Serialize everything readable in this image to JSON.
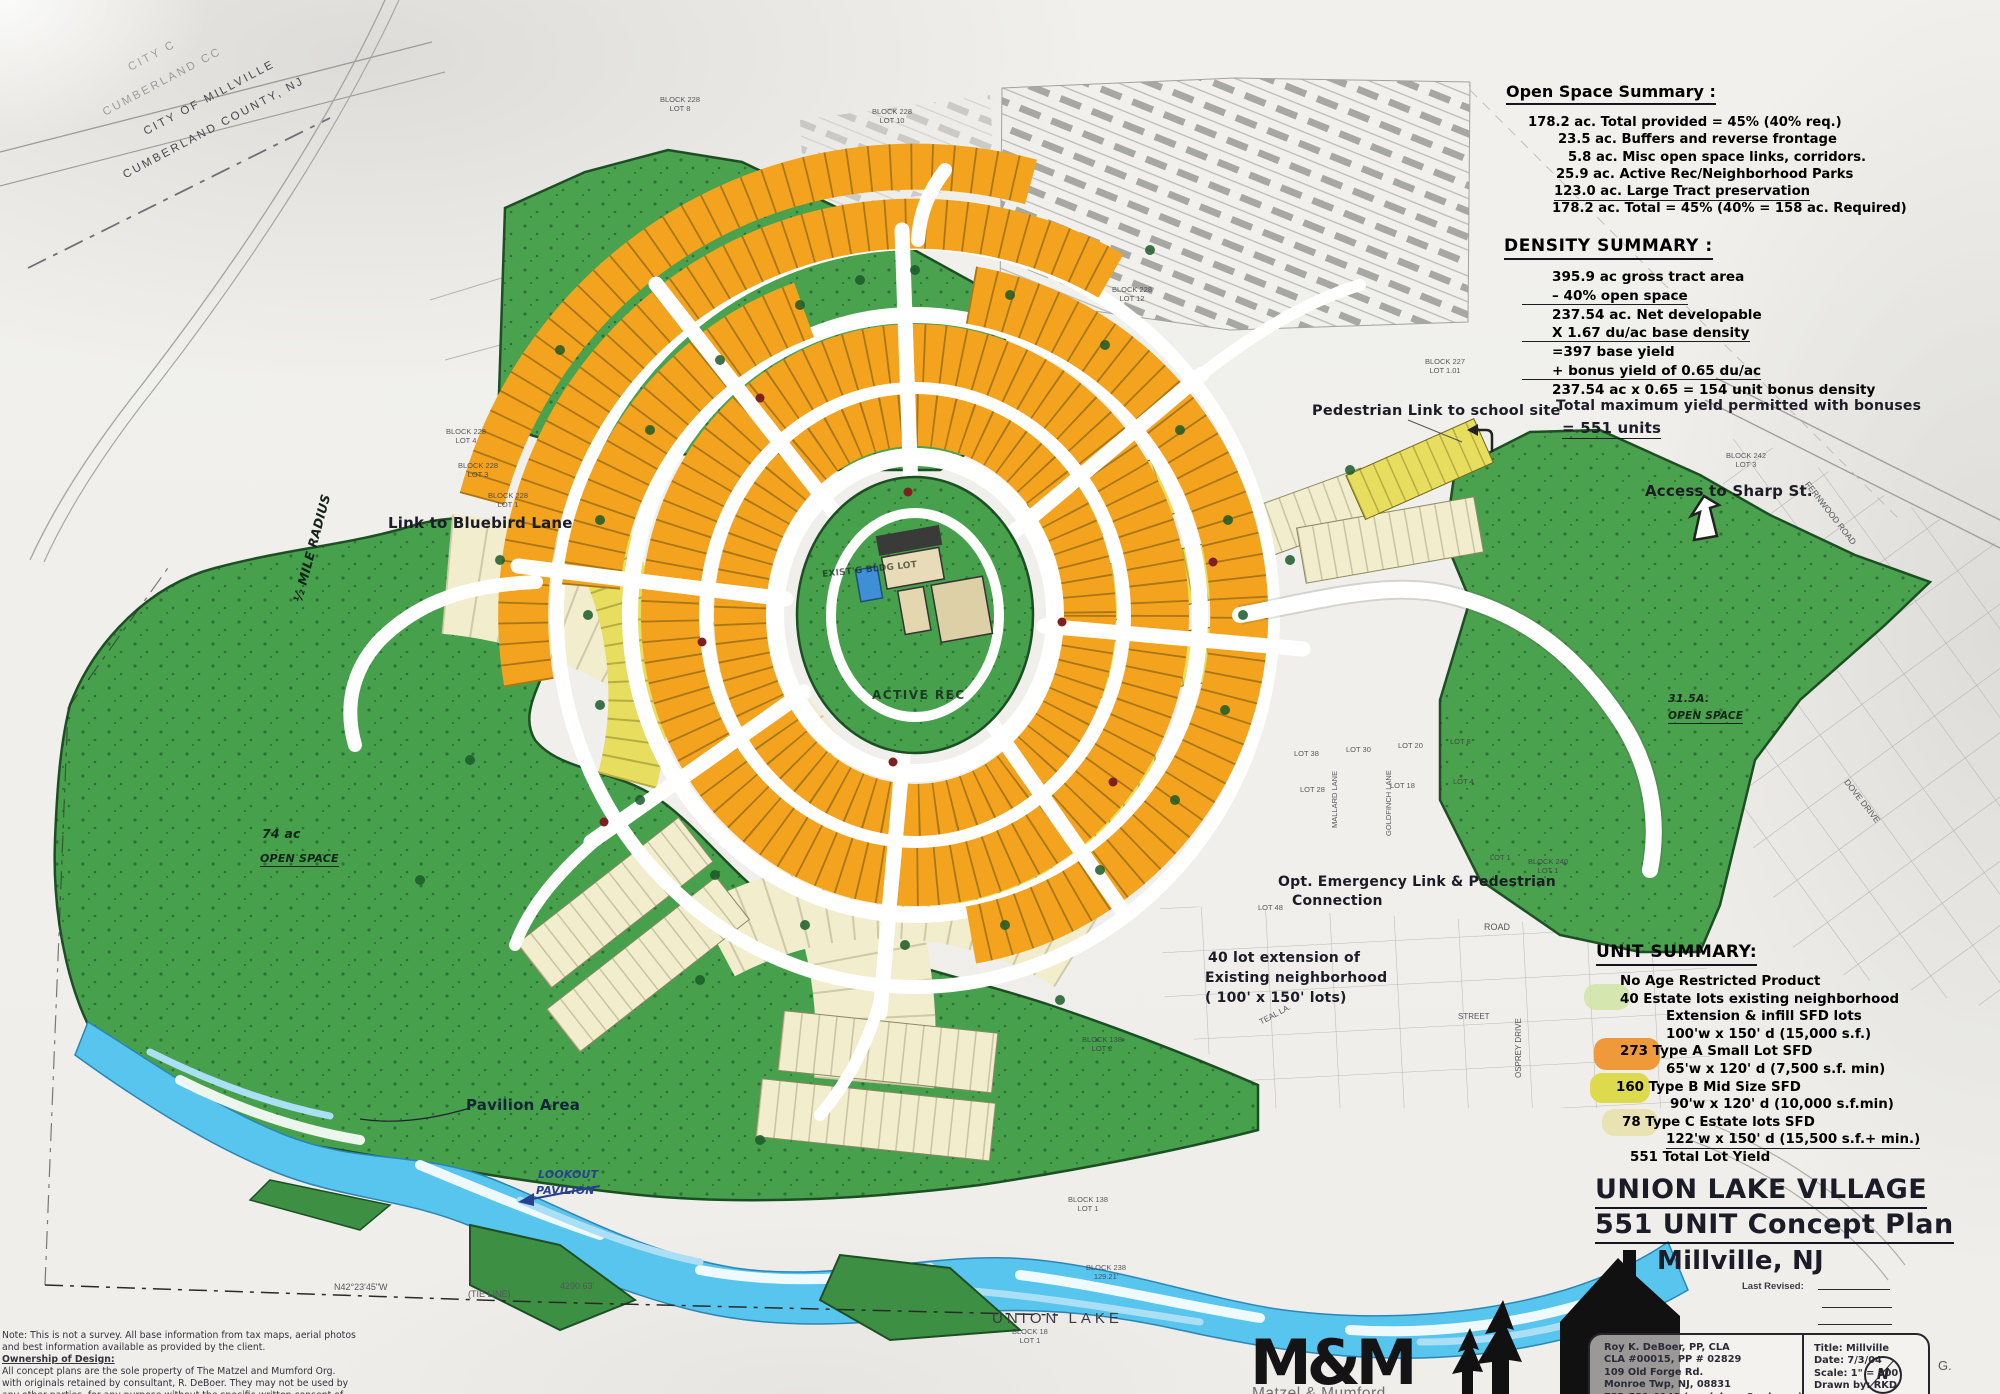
{
  "colors": {
    "paper": "#f1f0ec",
    "ink": "#1c1c28",
    "print_grey": "#55555c",
    "preserve_green": "#4aa24e",
    "green_dark": "#1d4f24",
    "lot_orange": "#f3a31d",
    "lot_yellow": "#e7dd5e",
    "lot_cream": "#f1edcd",
    "river_blue": "#57c5ee",
    "note_blue": "#27418f"
  },
  "corner_stamp": {
    "line1": "CITY C",
    "line2": "CUMBERLAND CC",
    "line3": "CITY OF MILLVILLE",
    "line4": "CUMBERLAND COUNTY, NJ"
  },
  "open_space_summary": {
    "title": "Open Space Summary :",
    "lines": [
      "178.2 ac.  Total provided = 45% (40% req.)",
      "23.5 ac. Buffers and reverse frontage",
      "5.8 ac. Misc open space links, corridors.",
      "25.9 ac. Active Rec/Neighborhood Parks",
      "123.0  ac. Large Tract preservation",
      "178.2 ac. Total = 45% (40% = 158 ac. Required)"
    ]
  },
  "density_summary": {
    "title": "DENSITY SUMMARY :",
    "lines": [
      "395.9 ac gross tract area",
      "– 40% open space",
      "237.54 ac. Net developable",
      "X 1.67 du/ac base density",
      "=397 base yield",
      "+ bonus yield of 0.65 du/ac",
      "237.54 ac x 0.65 = 154 unit bonus density"
    ],
    "total_note": "Total maximum yield permitted with bonuses",
    "total_value": "= 551 units"
  },
  "unit_summary": {
    "title": "UNIT SUMMARY:",
    "rows": [
      "No Age Restricted Product",
      "40 Estate lots existing neighborhood",
      "Extension & infill  SFD lots",
      "100'w x 150' d (15,000 s.f.)",
      "273 Type A Small Lot SFD",
      "65'w x 120' d (7,500 s.f. min)",
      "160 Type B  Mid Size SFD",
      "90'w x 120' d (10,000 s.f.min)",
      "78 Type C Estate lots SFD",
      "122'w x 150' d (15,500 s.f.+ min.)",
      "551 Total Lot Yield"
    ]
  },
  "plan_title": {
    "line1": "UNION LAKE VILLAGE",
    "line2": "551 UNIT Concept Plan",
    "line3": "Millville, NJ",
    "last_revised": "Last Revised:"
  },
  "consultant": {
    "line1": "Roy K. DeBoer, PP, CLA",
    "line2": "CLA #00015, PP # 02829",
    "line3": "109 Old Forge Rd.",
    "line4": "Monroe Twp, NJ, 08831",
    "line5": "732-521-0148 (roydeboer@aol.com)"
  },
  "fields": {
    "title": "Title: Millville",
    "date": "Date: 7/3/04",
    "scale": "Scale: 1\" = 300'",
    "drawn": "Drawn by: RKD"
  },
  "logo": {
    "mark": "M&M",
    "name": "Matzel & Mumford"
  },
  "labels": {
    "bluebird": "Link to Bluebird Lane",
    "pedestrian": "Pedestrian Link to school site",
    "sharp": "Access to Sharp St.",
    "emergency_1": "Opt. Emergency Link & Pedestrian",
    "emergency_2": "Connection",
    "extension_1": "40 lot extension of",
    "extension_2": "Existing neighborhood",
    "extension_3": "( 100' x 150' lots)",
    "pavilion": "Pavilion Area",
    "lookout_1": "LOOKOUT",
    "lookout_2": "PAVILION",
    "union_lake": "UNION LAKE",
    "active_rec": "ACTIVE REC",
    "existing": "EXIST'G BLDG LOT",
    "open_74": "74 ac",
    "open_74b": "OPEN SPACE",
    "open_315": "31.5A.",
    "open_315b": "OPEN SPACE",
    "half_mile": "½ MILE RADIUS"
  },
  "streets": {
    "teal": "TEAL LA.",
    "street": "STREET",
    "road": "ROAD",
    "fernwood": "FERNWOOD ROAD",
    "dove": "DOVE DRIVE",
    "osprey": "OSPREY DRIVE",
    "mallard": "MALLARD LANE",
    "goldfinch": "GOLDFINCH LANE"
  },
  "block_labels": [
    {
      "block": "BLOCK 228",
      "lot": "LOT 8"
    },
    {
      "block": "BLOCK 228",
      "lot": "LOT 10"
    },
    {
      "block": "BLOCK 228",
      "lot": "LOT 12"
    },
    {
      "block": "BLOCK 227",
      "lot": "LOT 1.01"
    },
    {
      "block": "BLOCK 228",
      "lot": "LOT 4"
    },
    {
      "block": "BLOCK 228",
      "lot": "LOT 3"
    },
    {
      "block": "BLOCK 228",
      "lot": "LOT 1"
    },
    {
      "block": "BLOCK 242",
      "lot": "LOT 3"
    },
    {
      "block": "BLOCK 240",
      "lot": "LOT 1"
    },
    {
      "block": "BLOCK 138",
      "lot": "LOT 2"
    },
    {
      "block": "BLOCK 138",
      "lot": "LOT 1"
    },
    {
      "block": "BLOCK 18",
      "lot": "LOT 1"
    },
    {
      "block": "BLOCK 238",
      "lot": "129.21'"
    }
  ],
  "lot_labels": [
    "LOT 38",
    "LOT 30",
    "LOT 20",
    "LOT 8",
    "LOT 28",
    "LOT 18",
    "LOT 4",
    "LOT 48",
    "LOT 1"
  ],
  "survey": {
    "bearing": "N42°23'45\"W",
    "tie": "(TIE LINE)",
    "distance": "4290.63'",
    "g_mark": "G.",
    "north": "N"
  },
  "disclaimer": {
    "lines": [
      "Note: This is not a survey. All base information from tax maps, aerial photos",
      "and best information available as provided by the client.",
      "Ownership of Design:",
      "All concept plans are the sole property of The Matzel and Mumford Org.",
      "with originals retained by consultant, R. DeBoer. They may not be used by",
      "any other parties, for any purpose without the specific written consent of"
    ]
  }
}
